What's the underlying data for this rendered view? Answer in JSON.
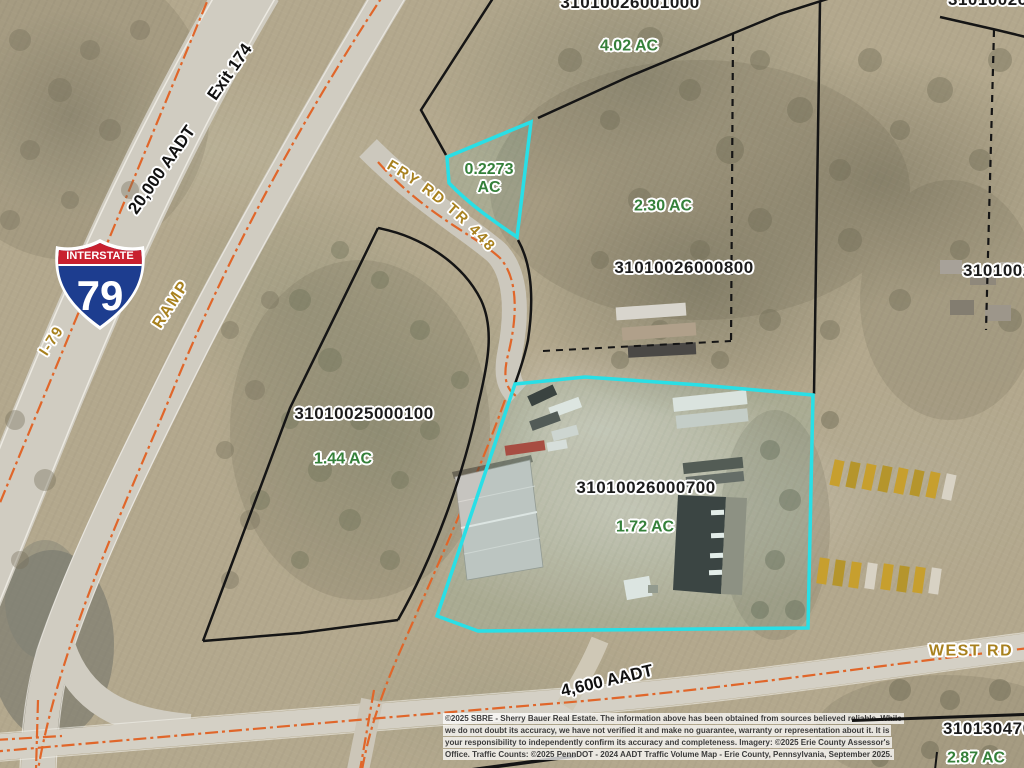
{
  "parcels": {
    "p1000": {
      "id": "31010026001000",
      "acreage": "4.02 AC"
    },
    "p_highlight_small": {
      "acreage": "0.2273",
      "acreage_unit": "AC"
    },
    "p800": {
      "id": "31010026000800",
      "acreage": "2.30 AC"
    },
    "p100": {
      "id": "31010025000100",
      "acreage": "1.44 AC"
    },
    "p700": {
      "id": "31010026000700",
      "acreage": "1.72 AC"
    },
    "p_east_partial": {
      "id": "3101002"
    },
    "p_topright_partial": {
      "id": "31010026"
    },
    "p470": {
      "id": "310130470",
      "acreage": "2.87 AC"
    }
  },
  "roads": {
    "interstate_banner": "INTERSTATE",
    "interstate_number": "79",
    "i79_label": "I-79",
    "ramp_label": "RAMP",
    "highway_aadt": "20,000 AADT",
    "exit_label": "Exit 174",
    "fry_rd_label": "FRY RD TR 448",
    "west_rd_label": "WEST RD",
    "west_rd_aadt": "4,600 AADT"
  },
  "disclaimer": {
    "line1": "©2025 SBRE - Sherry Bauer Real Estate. The information above has been obtained from sources believed reliable. While",
    "line2": "we do not doubt its accuracy, we have not verified it and make no guarantee, warranty or representation about it. It is",
    "line3": "your responsibility to independently confirm its accuracy and completeness. Imagery: ©2025 Erie County Assessor's",
    "line4": "Office. Traffic Counts: ©2025 PennDOT - 2024 AADT Traffic Volume Map - Erie County, Pennsylvania, September 2025."
  },
  "colors": {
    "parcel_highlight": "#29dfe6",
    "boundary_line": "#151515",
    "road_centerline": "#e0662a",
    "acreage_green": "#35803a",
    "road_label_gold": "#a8811f",
    "shield_blue": "#1d3d8f",
    "shield_red": "#c8202f"
  }
}
